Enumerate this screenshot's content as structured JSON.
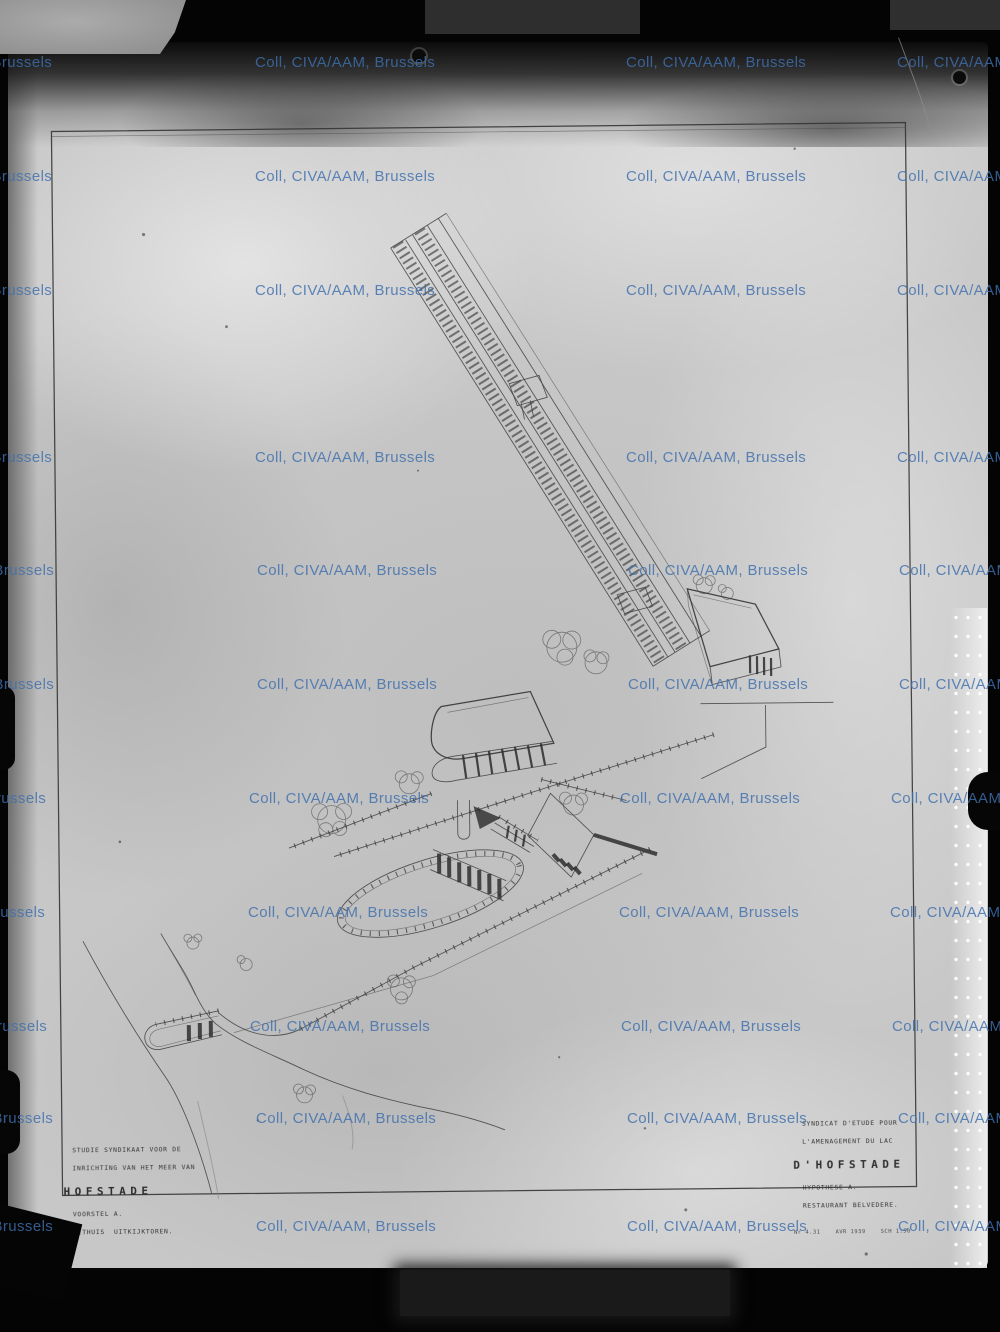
{
  "watermark": {
    "text": "Coll, CIVA/AAM, Brussels",
    "color": "#3f6fad",
    "rows_y": [
      54,
      168,
      282,
      449,
      562,
      676,
      790,
      904,
      1018,
      1110,
      1218
    ],
    "cols_x": [
      -128,
      255,
      626,
      897
    ],
    "row_dx": [
      0,
      0,
      0,
      0,
      2,
      2,
      -6,
      -7,
      -5,
      1,
      1
    ]
  },
  "title_block_nl": {
    "line1": "STUDIE SYNDIKAAT VOOR DE",
    "line2": "INRICHTING VAN HET MEER VAN",
    "title": "HOFSTADE",
    "line4": "VOORSTEL A.",
    "line5": "EETHUIS  UITKIJKTOREN."
  },
  "title_block_fr": {
    "line1": "SYNDICAT D'ETUDE POUR",
    "line2": "L'AMENAGEMENT DU LAC",
    "title": "D'HOFSTADE",
    "line4": "HYPOTHESE A.",
    "line5": "RESTAURANT BELVEDERE.",
    "stamp": "Nr 4.31    AVR 1939    SCH 1:50"
  },
  "colors": {
    "watermark_blue": "#3f6fad",
    "plate_gray": "#c7c7c7",
    "ink": "#3c3c3c",
    "background_black": "#040404"
  }
}
